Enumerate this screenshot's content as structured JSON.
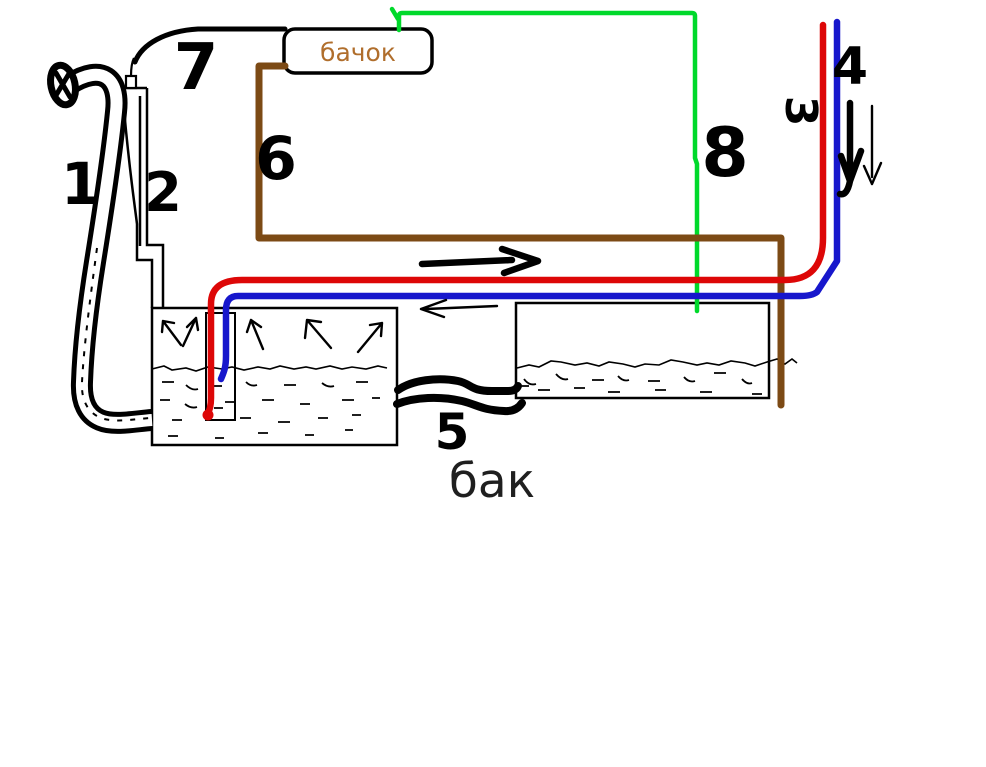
{
  "canvas": {
    "width": 986,
    "height": 767,
    "background": "#ffffff"
  },
  "labels": {
    "n1": "1",
    "n2": "2",
    "n3": "3",
    "n4": "4",
    "n5": "5",
    "n6": "6",
    "n7": "7",
    "n8": "8",
    "reservoir": "бачок",
    "tank": "бак"
  },
  "colors": {
    "ink": "#000000",
    "red_pipe": "#dd0707",
    "blue_pipe": "#1717cc",
    "green_pipe": "#00d92b",
    "brown_pipe": "#7c4a15",
    "reservoir_text": "#b06e2c",
    "tank_text": "#1f1f1f"
  }
}
